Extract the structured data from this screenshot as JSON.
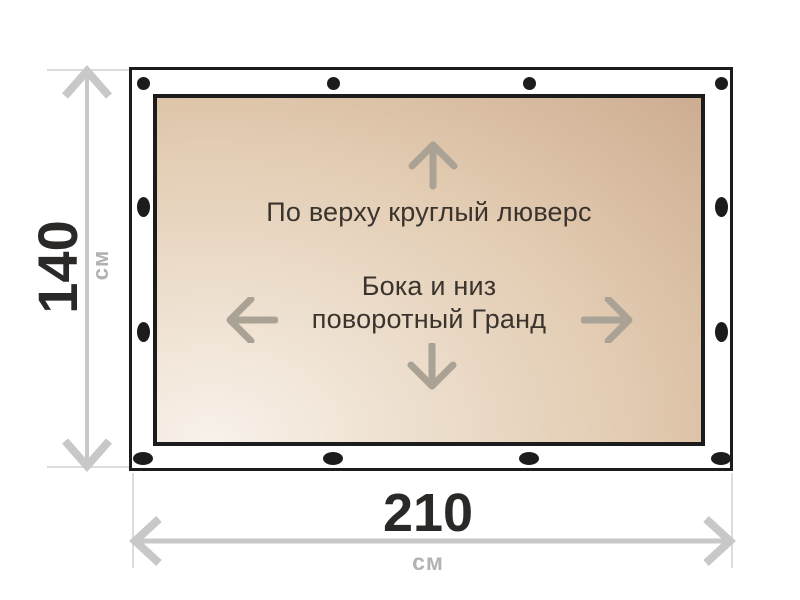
{
  "colors": {
    "outline": "#1c1c1c",
    "grommet": "#1c1c1c",
    "tarp_gradient_light": "#f8f2ea",
    "tarp_gradient_mid": "#e2cbb1",
    "tarp_gradient_dark": "#c7a487",
    "dimension_line": "#c8c8c8",
    "extension_line": "#dcdcdc",
    "dimension_value_text": "#2a2927",
    "dimension_unit_text": "#b2b2b2",
    "note_text": "#3a342d",
    "inner_arrow": "#aaa295"
  },
  "height_dimension": {
    "value": "140",
    "unit": "см"
  },
  "width_dimension": {
    "value": "210",
    "unit": "см"
  },
  "banner_notes": {
    "top": "По верху круглый люверс",
    "middle_line1": "Бока и низ",
    "middle_line2": "поворотный Гранд"
  },
  "icons": {
    "up": "arrow-up-icon",
    "down": "arrow-down-icon",
    "left": "arrow-left-icon",
    "right": "arrow-right-icon"
  }
}
